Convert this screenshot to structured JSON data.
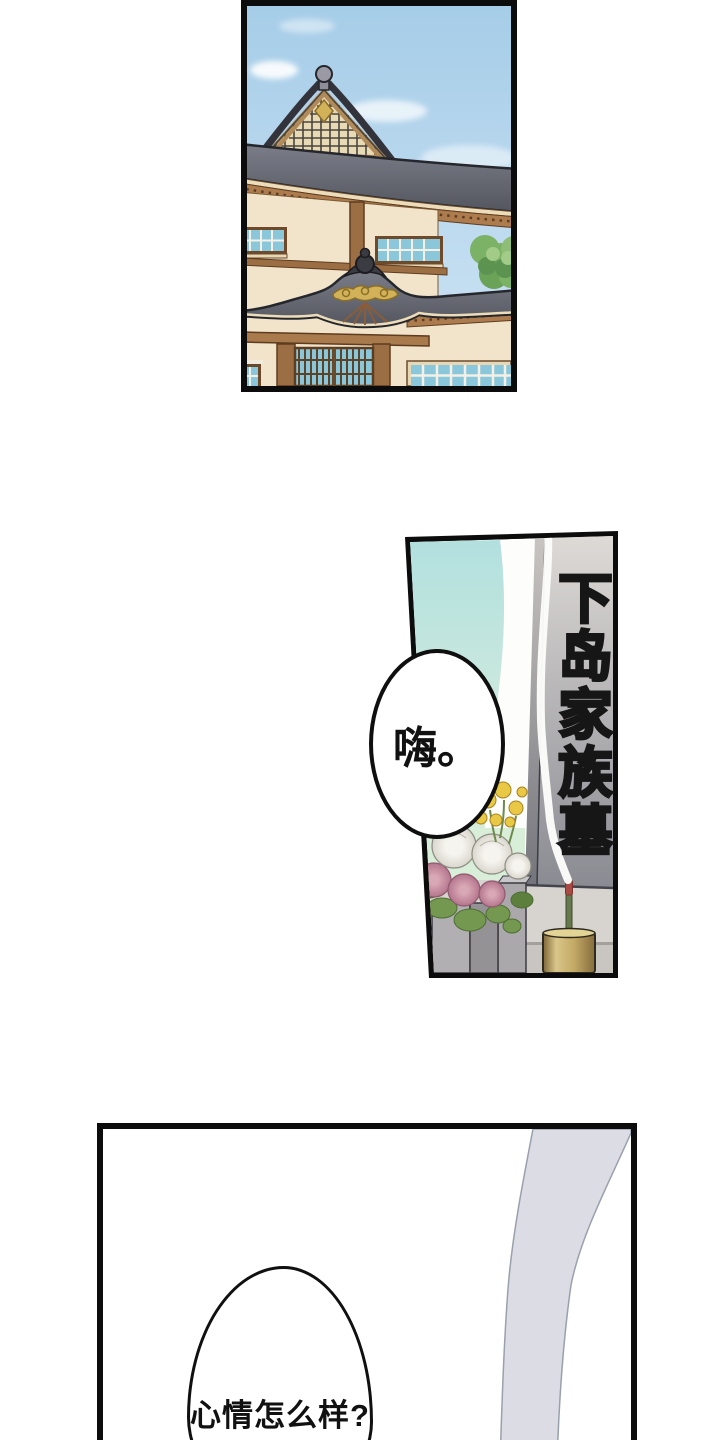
{
  "frame_color": "#0c0c0c",
  "panel1": {
    "colors": {
      "sky_top": "#a6cde8",
      "sky_bottom": "#cfe4f4",
      "roof_top": "#7b7e88",
      "roof_bottom": "#53565f",
      "wall": "#f1e4ca",
      "beam": "#9c6e44",
      "window_pane": "#8bc7da",
      "tree": "#7cb266",
      "gold": "#d2b258"
    }
  },
  "panel2": {
    "grave_inscription": "下岛家族墓",
    "speech_bubble": {
      "text": "嗨。"
    },
    "colors": {
      "teal_top": "#b2e0df",
      "teal_mid": "#cfeadd",
      "mint": "#d9eed9",
      "stone_top": "#dedbd7",
      "stone_bottom": "#8a8a92",
      "ink_top": "#c9c4be",
      "ink_bottom": "#4f4f57",
      "flower_pink": "#c98fa0",
      "flower_white": "#efece6",
      "flower_yellow": "#e8c844",
      "leaf": "#74984f",
      "vase_left": "#b1afb1",
      "vase_right": "#949295",
      "holder_gold": "#c3a964",
      "incense_stick": "#66794c",
      "incense_tip": "#a84b44",
      "smoke": "#fcfcfa"
    }
  },
  "panel3": {
    "speech_bubble": {
      "text": "心情怎么样?"
    },
    "colors": {
      "sleeve_fill": "#dcdce4",
      "sleeve_stroke": "#9aa0ac"
    }
  }
}
